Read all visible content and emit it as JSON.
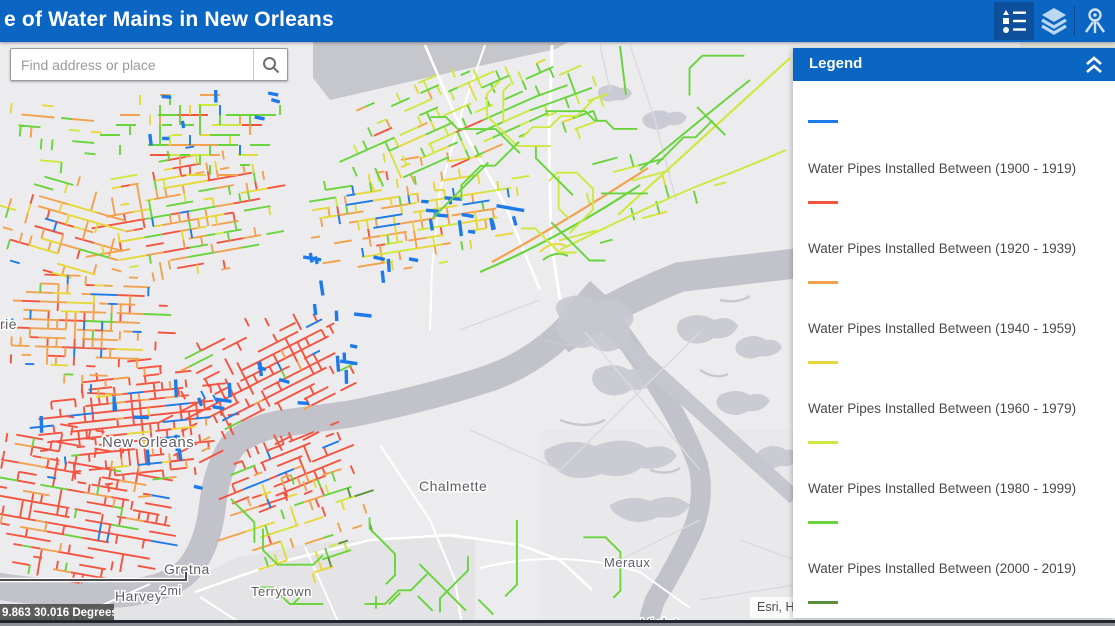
{
  "header": {
    "title": "e of Water Mains in New Orleans",
    "icons": [
      {
        "name": "legend-list",
        "active": true
      },
      {
        "name": "layers",
        "active": false
      },
      {
        "name": "attribute-pin",
        "active": false
      }
    ]
  },
  "search": {
    "placeholder": "Find address or place"
  },
  "legend": {
    "title": "Legend",
    "partial_swatch_color": "#1e7ae8",
    "items": [
      {
        "label": "Water Pipes Installed Between (1900 - 1919)",
        "color": "#f4543f"
      },
      {
        "label": "Water Pipes Installed Between (1920 - 1939)",
        "color": "#f2a24e"
      },
      {
        "label": "Water Pipes Installed Between (1940 - 1959)",
        "color": "#e7d839"
      },
      {
        "label": "Water Pipes Installed Between (1960 - 1979)",
        "color": "#cde93f"
      },
      {
        "label": "Water Pipes Installed Between (1980 - 1999)",
        "color": "#69d43c"
      },
      {
        "label": "Water Pipes Installed Between (2000 - 2019)",
        "color": "#5d8e3e"
      }
    ]
  },
  "map": {
    "scale_label": "2mi",
    "coordinates": "9.863 30.016 Degrees",
    "attribution": "Esri, H",
    "labels": [
      {
        "text": "rie",
        "x": 0,
        "y": 329,
        "size": 14
      },
      {
        "text": "New Orleans",
        "x": 102,
        "y": 447,
        "size": 15
      },
      {
        "text": "Chalmette",
        "x": 419,
        "y": 491,
        "size": 14
      },
      {
        "text": "Gretna",
        "x": 164,
        "y": 574,
        "size": 14
      },
      {
        "text": "Harvey",
        "x": 115,
        "y": 601,
        "size": 14
      },
      {
        "text": "Terrytown",
        "x": 251,
        "y": 596,
        "size": 13
      },
      {
        "text": "Meraux",
        "x": 604,
        "y": 567,
        "size": 13
      },
      {
        "text": "Violet",
        "x": 641,
        "y": 628,
        "size": 14
      },
      {
        "text": "Marrero",
        "x": 25,
        "y": 623,
        "size": 16
      }
    ],
    "colors": {
      "land": "#ececef",
      "water": "#c2c2cb",
      "marsh": "#c8c8d1",
      "lake": "#c6c6cd"
    }
  }
}
